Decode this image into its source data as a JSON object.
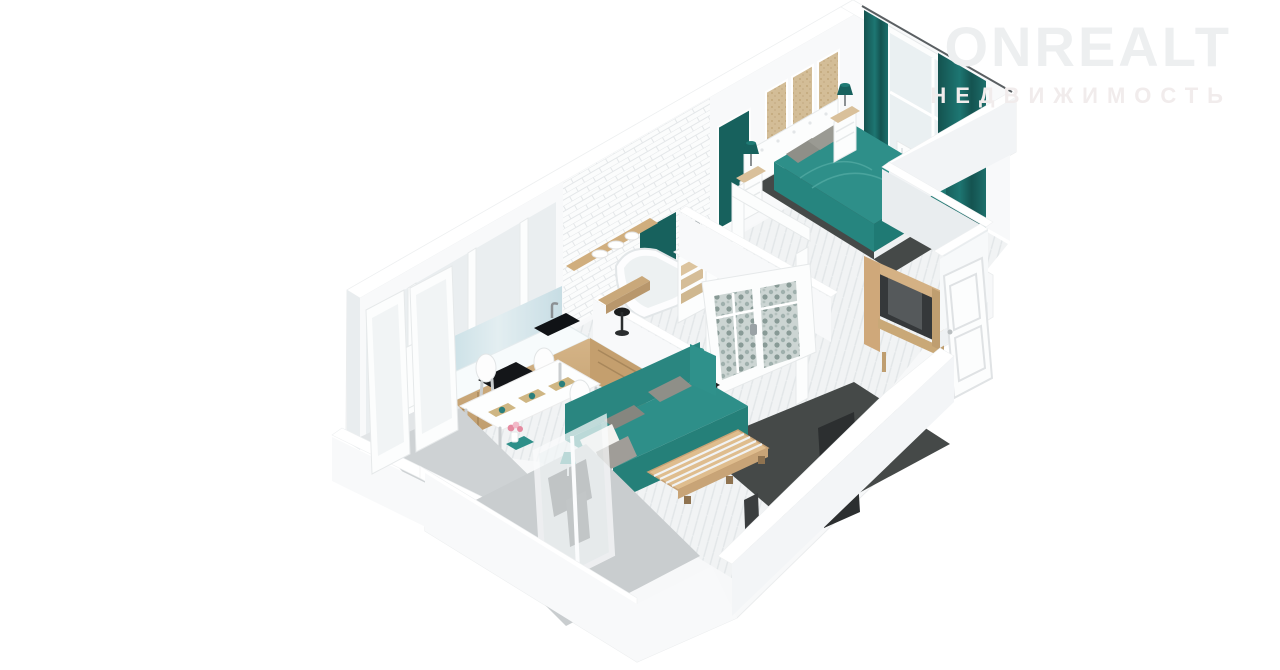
{
  "watermark": {
    "brand": "ONREALT",
    "tagline": "НЕДВИЖИМОСТЬ"
  },
  "palette": {
    "teal": "#2e8f89",
    "tealDeep": "#1f7a74",
    "tealDark": "#17615d",
    "wood": "#c9a97c",
    "woodLight": "#dcbb8d",
    "woodDark": "#b08a58",
    "wall": "#f8f9fa",
    "wallShade": "#e9edef",
    "floor": "#f1f3f4",
    "floorLine": "#e2e6e8",
    "balconyFloor": "#ced2d4",
    "rug": "#454948",
    "charcoal": "#2c2f30",
    "glassBlue": "#bcd8e0",
    "glassLight": "#eaf0f2",
    "pillow": "#8f8f88",
    "metal": "#9aa2a5",
    "black": "#141619",
    "flower": "#e58aa0",
    "watermark": "#edeff0",
    "watermarkSub": "#f1ecec"
  },
  "scene": {
    "type": "3d-floorplan-render",
    "style": "isometric dollhouse cutaway, white walls, teal accents, light oak wood",
    "rooms": [
      {
        "name": "bedroom",
        "items": [
          "double-bed-teal",
          "white-tufted-headboard",
          "nightstand-left",
          "nightstand-right",
          "teal-table-lamps",
          "wood-wall-panels",
          "window",
          "teal-curtains",
          "radiator",
          "dark-rug",
          "teal-door"
        ]
      },
      {
        "name": "bathroom",
        "items": [
          "corner-bathtub",
          "teal-accent-panel",
          "vanity-with-sink",
          "subway-tile-wall",
          "towel-box"
        ]
      },
      {
        "name": "kitchen",
        "items": [
          "l-shaped-counter",
          "black-cooktop",
          "black-sink",
          "fridge",
          "wood-shelf-with-dishes",
          "bar-counter",
          "bar-stool",
          "blue-glass-backsplash"
        ]
      },
      {
        "name": "dining-area",
        "items": [
          "white-table",
          "white-chairs-x4",
          "placemats",
          "flower-vase",
          "teal-runner"
        ]
      },
      {
        "name": "living-room",
        "items": [
          "teal-sofa",
          "gray-pillows",
          "pallet-coffee-table",
          "dark-rug",
          "tv-panel",
          "side-table",
          "teal-lamp",
          "french-doors-leaf-glass"
        ]
      },
      {
        "name": "hallway",
        "items": [
          "wood-wardrobe-open",
          "bench",
          "entrance-door-open"
        ]
      },
      {
        "name": "balcony-left",
        "items": [
          "empty",
          "glazing"
        ]
      },
      {
        "name": "balcony-bottom",
        "items": [
          "desk",
          "teal-lamp",
          "chair",
          "glass-partition"
        ]
      }
    ]
  }
}
